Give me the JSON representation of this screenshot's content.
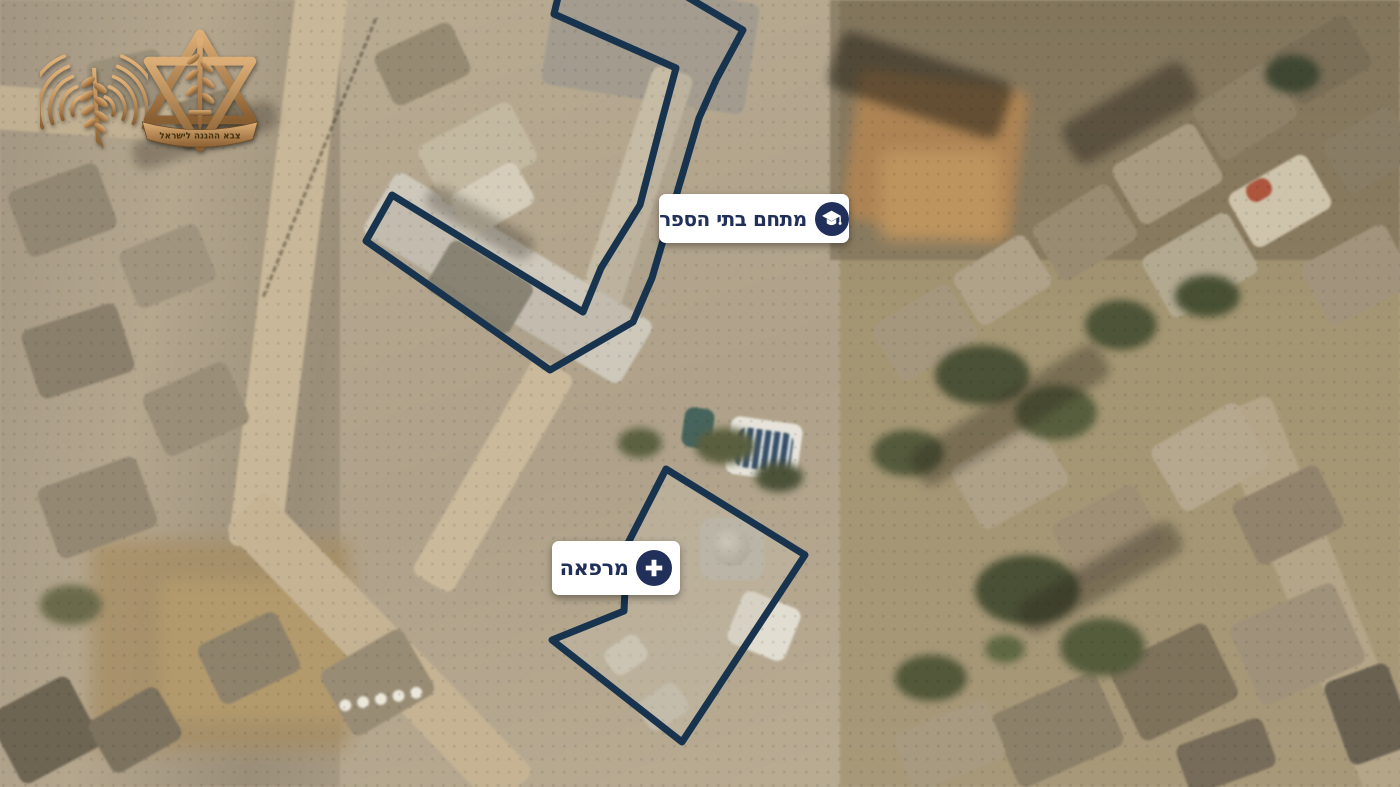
{
  "branding": {
    "spokesperson_logo": "idf-spokesperson-radio-logo",
    "idf_emblem": "idf-army-emblem",
    "idf_emblem_ribbon_text": "צבא ההגנה לישראל"
  },
  "map": {
    "type": "satellite-aerial-annotated",
    "annotations": [
      {
        "id": "school_compound",
        "label": "מתחם בתי הספר",
        "icon": "graduation-cap",
        "polygon_points": "561,-15 554,14 676,68 662,120 640,205 601,268 583,312 392,195 366,241 550,370 633,322 652,278 699,118 716,80 743,30 667,-15",
        "label_box": {
          "left": 659,
          "top": 194
        }
      },
      {
        "id": "clinic",
        "label": "מרפאה",
        "icon": "medical-cross",
        "polygon_points": "666,469 805,555 682,742 552,640 624,611 627,545",
        "label_box": {
          "left": 552,
          "top": 541
        }
      }
    ],
    "colors": {
      "outline_navy": "#17334e",
      "label_background": "#ffffff",
      "label_text_navy": "#20305a",
      "icon_circle_navy": "#20305a",
      "logo_bronze": "#c2925d"
    }
  }
}
